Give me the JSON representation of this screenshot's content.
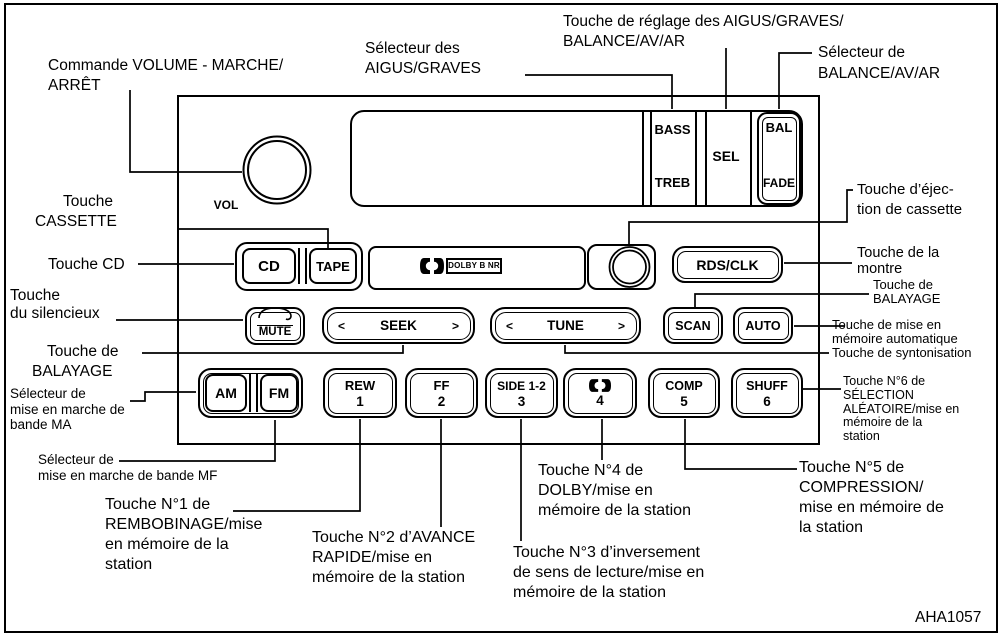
{
  "figure_code": "AHA1057",
  "unit": {
    "vol": "VOL",
    "display": {
      "bass": "BASS",
      "treb": "TREB",
      "sel": "SEL",
      "bal": "BAL",
      "fade": "FADE"
    },
    "dolby_nr": "DOLBY B NR",
    "buttons": {
      "cd": "CD",
      "tape": "TAPE",
      "ej": "EJ",
      "rds_clk": "RDS/CLK",
      "mute": "MUTE",
      "seek": "SEEK",
      "tune": "TUNE",
      "scan": "SCAN",
      "auto": "AUTO",
      "am": "AM",
      "fm": "FM",
      "rew": "REW",
      "rew_num": "1",
      "ff": "FF",
      "ff_num": "2",
      "side": "SIDE 1-2",
      "side_num": "3",
      "dolby_num": "4",
      "comp": "COMP",
      "comp_num": "5",
      "shuff": "SHUFF",
      "shuff_num": "6",
      "arrow_left": "<",
      "arrow_right": ">"
    }
  },
  "callouts": {
    "volume": [
      "Commande VOLUME - MARCHE/",
      "ARRÊT"
    ],
    "bass_treb_selector": [
      "Sélecteur des",
      "AIGUS/GRAVES"
    ],
    "sel_adjust": [
      "Touche de réglage des AIGUS/GRAVES/",
      "BALANCE/AV/AR"
    ],
    "bal_fade_selector": [
      "Sélecteur de",
      "BALANCE/AV/AR"
    ],
    "cassette": [
      "Touche",
      "CASSETTE"
    ],
    "cd": [
      "Touche CD"
    ],
    "mute": [
      "Touche",
      "du silencieux"
    ],
    "seek": [
      "Touche de",
      "BALAYAGE"
    ],
    "eject": [
      "Touche d’éjec-",
      "tion de cassette"
    ],
    "clock": [
      "Touche de la",
      "montre"
    ],
    "scan": [
      "Touche de",
      "BALAYAGE"
    ],
    "auto_memory": [
      "Touche de mise en",
      "mémoire automatique"
    ],
    "tune": [
      "Touche de syntonisation"
    ],
    "am": [
      "Sélecteur de",
      "mise en marche de",
      "bande MA"
    ],
    "fm": [
      "Sélecteur de",
      "mise en marche de bande MF"
    ],
    "n1": [
      "Touche N°1 de",
      "REMBOBINAGE/mise",
      "en mémoire de la",
      "station"
    ],
    "n2": [
      "Touche N°2 d’AVANCE",
      "RAPIDE/mise en",
      "mémoire de la station"
    ],
    "n3": [
      "Touche N°3 d’inversement",
      "de sens de lecture/mise en",
      "mémoire de la station"
    ],
    "n4": [
      "Touche N°4 de",
      "DOLBY/mise en",
      "mémoire de la station"
    ],
    "n5": [
      "Touche N°5 de",
      "COMPRESSION/",
      "mise en mémoire de",
      "la station"
    ],
    "n6": [
      "Touche N°6 de",
      "SÉLECTION",
      "ALÉATOIRE/mise en",
      "mémoire de la",
      "station"
    ]
  }
}
